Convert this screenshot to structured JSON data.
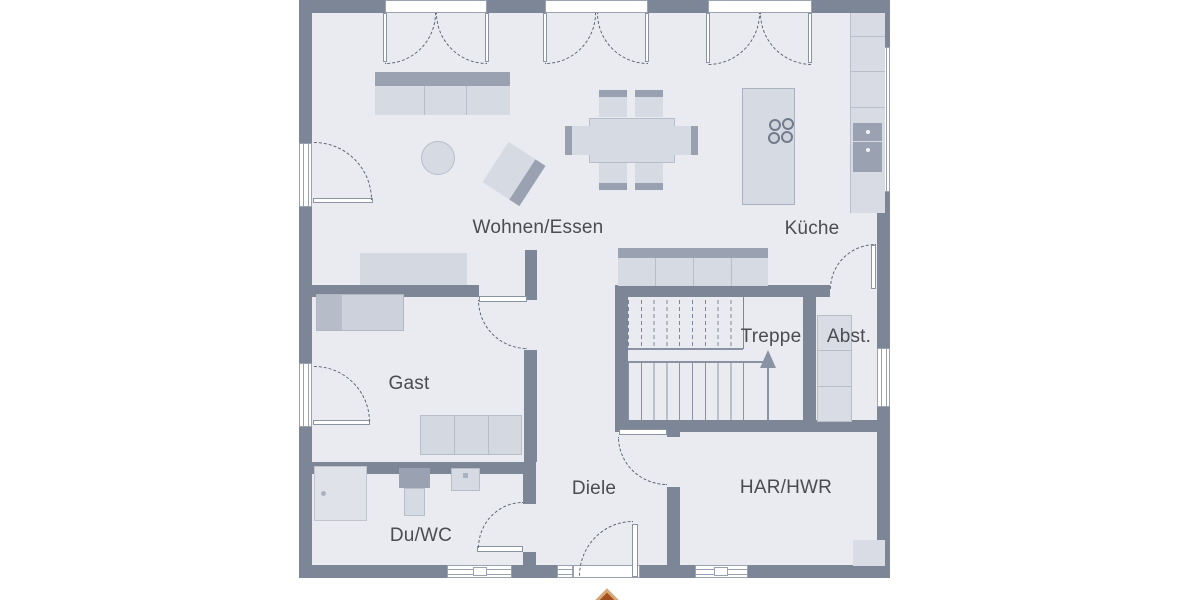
{
  "plan": {
    "type": "floor-plan",
    "language": "de",
    "rooms": {
      "living": {
        "label": "Wohnen/Essen"
      },
      "kitchen": {
        "label": "Küche"
      },
      "stairs": {
        "label": "Treppe"
      },
      "storage": {
        "label": "Abst."
      },
      "guest": {
        "label": "Gast"
      },
      "hall": {
        "label": "Diele"
      },
      "bath": {
        "label": "Du/WC"
      },
      "utility": {
        "label": "HAR/HWR"
      }
    },
    "symbols": [
      "sofa",
      "coffee-table",
      "armchair",
      "sideboard",
      "dining-table",
      "chairs",
      "kitchen-island",
      "cooktop-burners",
      "kitchen-counter",
      "oven",
      "drawer",
      "bed",
      "wardrobe",
      "shower",
      "toilet",
      "sink",
      "shelf",
      "appliance",
      "stairs-up-arrow",
      "entrance-arrow",
      "double-french-doors",
      "door-swing-arcs",
      "windows"
    ]
  },
  "colors": {
    "wall": "#7d8697",
    "floor": "#e9ebf1",
    "furniture": "#d6dae3",
    "furniture_dark": "#9aa2b2",
    "outline": "#9aa2b0",
    "text": "#4b4b52",
    "arrow": "#a2501d",
    "arrow_border": "#d9a878"
  }
}
